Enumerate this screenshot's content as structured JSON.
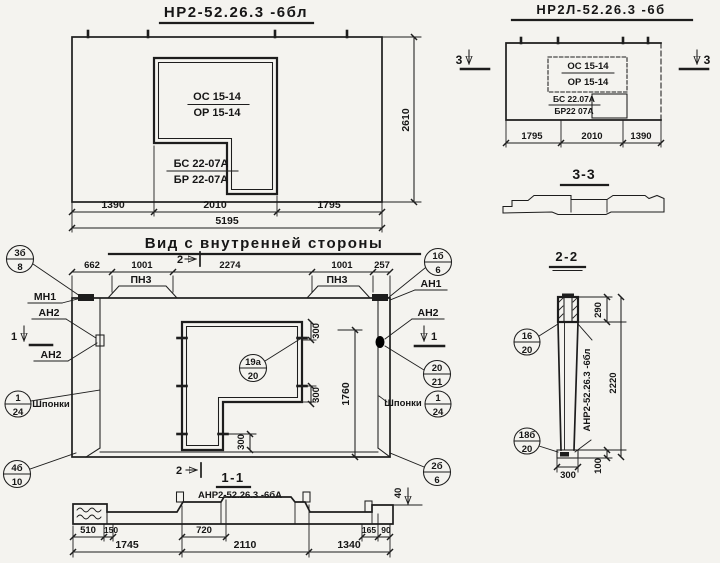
{
  "top_left_view": {
    "title": "НР2-52.26.3 -6бл",
    "opening_top": "ОС 15-14",
    "opening_bottom": "ОР 15-14",
    "block_top": "БС 22-07А",
    "block_bottom": "БР 22-07А",
    "dim_left": "1390",
    "dim_mid": "2010",
    "dim_right": "1795",
    "dim_total": "5195",
    "dim_height": "2610"
  },
  "top_right_view": {
    "title": "НР2Л-52.26.3 -6б",
    "opening_top": "ОС 15-14",
    "opening_bottom": "ОР 15-14",
    "block_top": "БС 22.07А",
    "block_bottom": "БР22 07А",
    "dim_left": "1795",
    "dim_mid": "2010",
    "dim_right": "1390",
    "marker": "3",
    "section_title": "3-3"
  },
  "main_view": {
    "title": "Вид с внутренней стороны",
    "dim_662": "662",
    "dim_1001a": "1001",
    "dim_2274": "2274",
    "dim_1001b": "1001",
    "dim_257": "257",
    "dim_1760": "1760",
    "dim_300": "300",
    "label_mn1": "МН1",
    "label_an2": "АН2",
    "label_an1": "АН1",
    "label_pn3": "ПН3",
    "label_shponki": "Шпонки",
    "marker_1": "1",
    "marker_2": "2"
  },
  "section_1_1": {
    "title": "1-1",
    "subtitle": "АНР2-52.26.3 -6бА",
    "dim_40": "40",
    "dim_510": "510",
    "dim_150": "150",
    "dim_720": "720",
    "dim_165": "165",
    "dim_90": "90",
    "dim_1745": "1745",
    "dim_2110": "2110",
    "dim_1340": "1340"
  },
  "section_2_2": {
    "title": "2-2",
    "label_vertical": "АНР2-52.26.3 -6бл",
    "dim_290": "290",
    "dim_2220": "2220",
    "dim_100": "100",
    "dim_300": "300"
  },
  "callouts": {
    "c3b8": {
      "top": "3б",
      "bottom": "8"
    },
    "c124_left": {
      "top": "1",
      "bottom": "24"
    },
    "c4b10": {
      "top": "4б",
      "bottom": "10"
    },
    "c1b6": {
      "top": "1б",
      "bottom": "6"
    },
    "c19a20": {
      "top": "19а",
      "bottom": "20"
    },
    "c2021": {
      "top": "20",
      "bottom": "21"
    },
    "c124_right": {
      "top": "1",
      "bottom": "24"
    },
    "c2b6": {
      "top": "2б",
      "bottom": "6"
    },
    "c1620": {
      "top": "16",
      "bottom": "20"
    },
    "c18b20": {
      "top": "18б",
      "bottom": "20"
    }
  }
}
